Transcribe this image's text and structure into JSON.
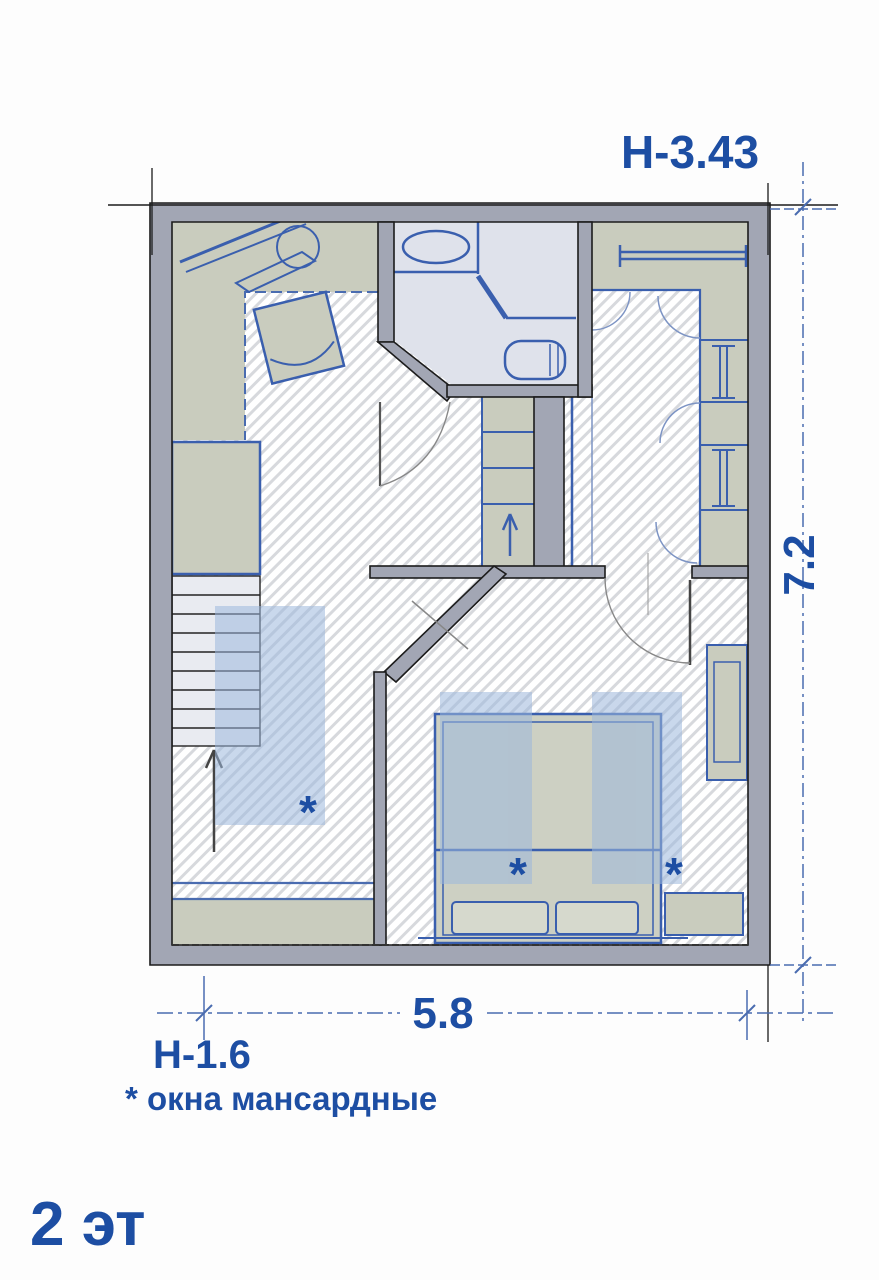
{
  "title": {
    "floor_label": "2 эт"
  },
  "dimensions": {
    "height_upper": "Н-3.43",
    "height_lower": "Н-1.6",
    "width_m": "5.8",
    "depth_m": "7.2"
  },
  "note": {
    "text": "* окна мансардные"
  },
  "markers": {
    "skylight": "*"
  },
  "colors": {
    "accent_blue": "#1d4ea3",
    "furniture_blue": "#3a5fae",
    "wall_gray": "#a2a6b4",
    "zone_olive": "#c9ccbe",
    "bath_floor": "#dfe2eb",
    "skylight_overlay": "#9db8dc"
  }
}
